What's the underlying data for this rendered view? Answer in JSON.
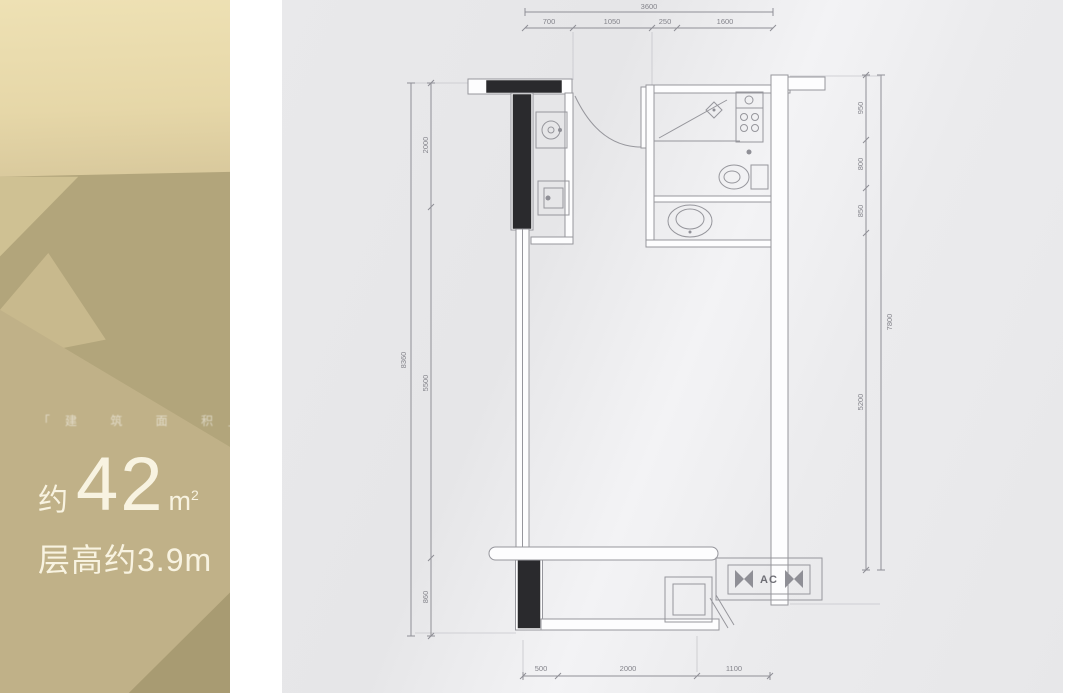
{
  "left_panel": {
    "tagline": "「建 筑 面 积」",
    "area_approx": "约",
    "area_value": "42",
    "area_unit_base": "m",
    "area_unit_sup": "2",
    "floor_height": "层高约3.9m"
  },
  "floor_plan": {
    "ac_label": "AC",
    "dimensions": {
      "top_total": "3600",
      "top_segments": [
        "700",
        "1050",
        "250",
        "1600"
      ],
      "bottom_segments": [
        "500",
        "2000",
        "1100"
      ],
      "left_total": "8360",
      "left_segments": [
        "2000",
        "5500",
        "860"
      ],
      "right_total": "7800",
      "right_segments": [
        "950",
        "800",
        "850",
        "5200"
      ]
    }
  }
}
